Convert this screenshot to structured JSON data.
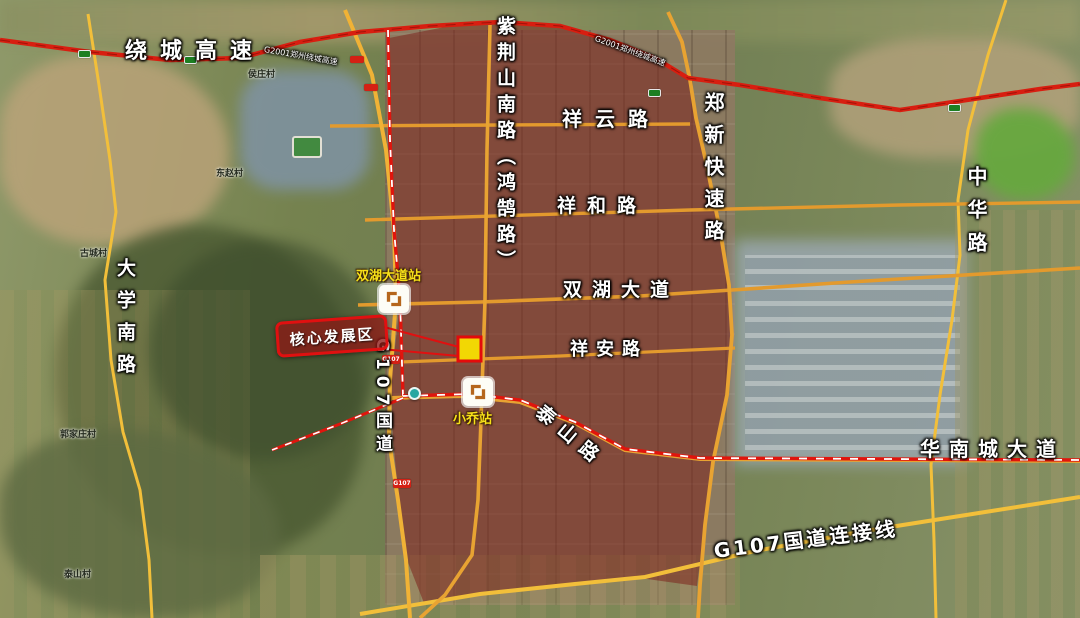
{
  "labels": {
    "ring_expressway": "绕城高速",
    "g2001_note": "G2001郑州绕城高速",
    "zijingshan_south_road": "紫荆山南路（鸿鹄路）",
    "xiangyun_road": "祥云路",
    "zhengxin_expressway": "郑新快速路",
    "zhonghua_road": "中华路",
    "xianghe_road": "祥和路",
    "shuanghu_avenue": "双湖大道",
    "xiangan_road": "祥安路",
    "daxue_south_road": "大学南路",
    "g107_national_road": "G107国道",
    "taishan_road": "泰山路",
    "huanancheng_avenue": "华南城大道",
    "g107_connector": "G107国道连接线"
  },
  "callout": {
    "label": "核心发展区"
  },
  "stations": [
    {
      "name": "双湖大道站"
    },
    {
      "name": "小乔站"
    }
  ],
  "shields": {
    "g107": "G107"
  },
  "villages": [
    "侯庄村",
    "东赵村",
    "古城村",
    "郭家庄村",
    "泰山村"
  ],
  "colors": {
    "overlay": "rgba(122,30,24,0.52)",
    "road_orange": "#e39a2d",
    "road_yellow": "#f2bf3a",
    "expressway_red": "#d81e10",
    "metro_red": "#e0150d",
    "station_label": "#f6e019",
    "core_site_fill": "#f2d704",
    "callout_red": "#e01010"
  }
}
